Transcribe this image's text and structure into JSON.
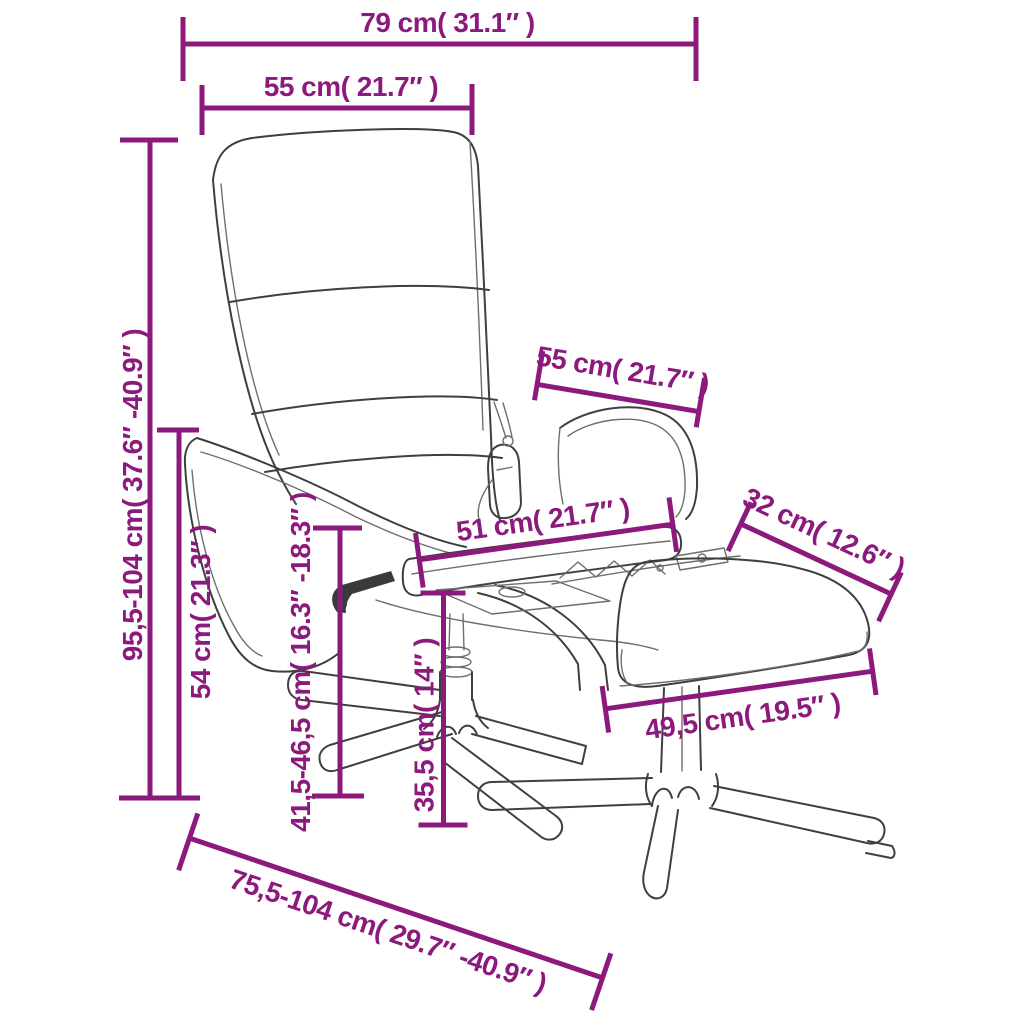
{
  "diagram": {
    "type": "product-dimension-diagram",
    "product": "massage recliner chair with footstool (line drawing)",
    "background": "#ffffff",
    "accent_color": "#8c1a7d",
    "line_art_color": "#3f3f3f",
    "dimensions": [
      {
        "id": "total-width",
        "label": "79 cm( 31.1″ )",
        "cm": "79",
        "inch": "31.1"
      },
      {
        "id": "backrest-width",
        "label": "55 cm( 21.7″ )",
        "cm": "55",
        "inch": "21.7"
      },
      {
        "id": "total-height",
        "label": "95,5-104 cm( 37.6″ -40.9″ )",
        "cm": "95,5-104",
        "inch": "37.6-40.9"
      },
      {
        "id": "armrest-height",
        "label": "54 cm( 21.3″ )",
        "cm": "54",
        "inch": "21.3"
      },
      {
        "id": "seat-height",
        "label": "41,5-46,5 cm( 16.3″ -18.3″ )",
        "cm": "41,5-46,5",
        "inch": "16.3-18.3"
      },
      {
        "id": "footstool-height",
        "label": "35,5 cm( 14″ )",
        "cm": "35,5",
        "inch": "14"
      },
      {
        "id": "seat-depth",
        "label": "51 cm( 21.7″ )",
        "cm": "51",
        "inch": "21.7"
      },
      {
        "id": "armrest-depth",
        "label": "55 cm( 21.7″ )",
        "cm": "55",
        "inch": "21.7"
      },
      {
        "id": "footstool-depth",
        "label": "32 cm( 12.6″ )",
        "cm": "32",
        "inch": "12.6"
      },
      {
        "id": "footstool-width",
        "label": "49,5 cm( 19.5″ )",
        "cm": "49,5",
        "inch": "19.5"
      },
      {
        "id": "total-depth",
        "label": "75,5-104 cm( 29.7″ -40.9″ )",
        "cm": "75,5-104",
        "inch": "29.7-40.9"
      }
    ]
  }
}
